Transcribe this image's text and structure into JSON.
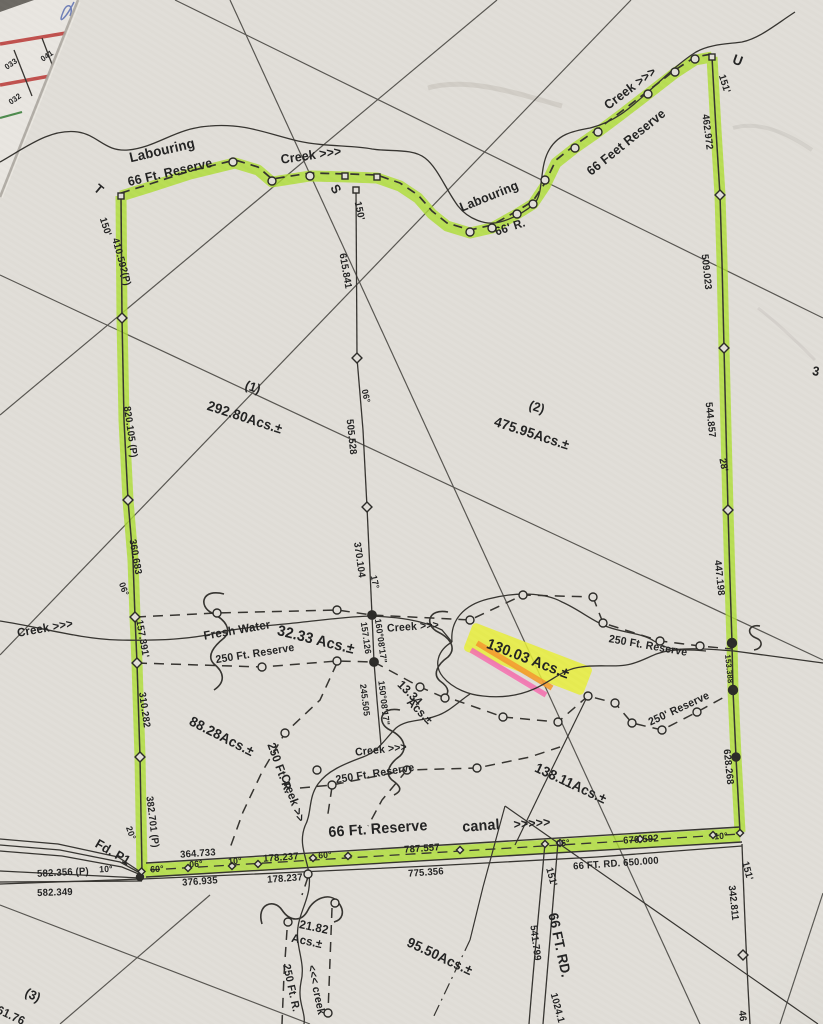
{
  "document_type_note": "hand-annotated survey plat photograph",
  "colors": {
    "highlight_green": "#aedd33",
    "highlight_yellow": "#e7ef3a",
    "highlight_orange": "#f49b2f",
    "highlight_pink": "#f472b0",
    "paper": "#e1ded8",
    "ink": "#222222",
    "fragment_red": "#c0504d"
  },
  "labels": [
    {
      "t": "033",
      "x": 11,
      "y": 64,
      "r": -35,
      "s": 8,
      "n": "underlying-sheet-lot-033"
    },
    {
      "t": "041",
      "x": 47,
      "y": 56,
      "r": -35,
      "s": 8,
      "n": "underlying-sheet-lot-041"
    },
    {
      "t": "032",
      "x": 15,
      "y": 99,
      "r": -35,
      "s": 8,
      "n": "underlying-sheet-lot-032"
    },
    {
      "t": "T",
      "x": 99,
      "y": 189,
      "r": 40,
      "s": 13,
      "n": "corner-T"
    },
    {
      "t": "Labouring",
      "x": 162,
      "y": 150,
      "r": -13,
      "s": 14,
      "n": "creek-name"
    },
    {
      "t": "66 Ft. Reserve",
      "x": 170,
      "y": 172,
      "r": -13,
      "s": 13,
      "n": "reserve-label"
    },
    {
      "t": "Creek >>>",
      "x": 311,
      "y": 155,
      "r": -8,
      "s": 13,
      "n": "creek-name"
    },
    {
      "t": "S",
      "x": 336,
      "y": 189,
      "r": 60,
      "s": 13,
      "n": "corner-S"
    },
    {
      "t": "150'",
      "x": 359,
      "y": 211,
      "r": 78,
      "s": 10
    },
    {
      "t": "150'",
      "x": 105,
      "y": 227,
      "r": 72,
      "s": 10
    },
    {
      "t": "Labouring",
      "x": 489,
      "y": 196,
      "r": -22,
      "s": 13,
      "n": "creek-name"
    },
    {
      "t": "66' R.",
      "x": 510,
      "y": 227,
      "r": -18,
      "s": 12
    },
    {
      "t": "Creek >>>",
      "x": 630,
      "y": 88,
      "r": -37,
      "s": 13,
      "n": "creek-name"
    },
    {
      "t": "66 Feet Reserve",
      "x": 626,
      "y": 142,
      "r": -39,
      "s": 13,
      "n": "reserve-label"
    },
    {
      "t": "U",
      "x": 738,
      "y": 60,
      "r": 20,
      "s": 14,
      "n": "corner-U"
    },
    {
      "t": "151'",
      "x": 724,
      "y": 84,
      "r": 72,
      "s": 10
    },
    {
      "t": "462.972",
      "x": 707,
      "y": 132,
      "r": 83,
      "s": 10
    },
    {
      "t": "509.023",
      "x": 706,
      "y": 272,
      "r": 84,
      "s": 10
    },
    {
      "t": "544.857",
      "x": 710,
      "y": 420,
      "r": 84,
      "s": 10
    },
    {
      "t": "28'",
      "x": 723,
      "y": 465,
      "r": 80,
      "s": 10
    },
    {
      "t": "3",
      "x": 816,
      "y": 371,
      "r": 10,
      "s": 13
    },
    {
      "t": "410.592(P)",
      "x": 121,
      "y": 262,
      "r": 75,
      "s": 10
    },
    {
      "t": "820.105 (P)",
      "x": 130,
      "y": 432,
      "r": 82,
      "s": 10
    },
    {
      "t": "360.683",
      "x": 135,
      "y": 557,
      "r": 80,
      "s": 10
    },
    {
      "t": "06°",
      "x": 124,
      "y": 589,
      "r": 70,
      "s": 9
    },
    {
      "t": "157.391'",
      "x": 142,
      "y": 639,
      "r": 80,
      "s": 10
    },
    {
      "t": "310.282",
      "x": 144,
      "y": 710,
      "r": 82,
      "s": 10
    },
    {
      "t": "382.701 (P)",
      "x": 152,
      "y": 822,
      "r": 83,
      "s": 10
    },
    {
      "t": "20°",
      "x": 131,
      "y": 833,
      "r": 70,
      "s": 9
    },
    {
      "t": "Fd. P1",
      "x": 113,
      "y": 852,
      "r": 30,
      "s": 13,
      "n": "found-pin-label"
    },
    {
      "t": "615.841",
      "x": 345,
      "y": 271,
      "r": 80,
      "s": 10
    },
    {
      "t": "(1)",
      "x": 253,
      "y": 387,
      "r": 18,
      "s": 13,
      "n": "parcel-1-number"
    },
    {
      "t": "292.80Acs.±",
      "x": 245,
      "y": 417,
      "r": 18,
      "s": 14,
      "n": "parcel-1-acreage"
    },
    {
      "t": "(2)",
      "x": 537,
      "y": 407,
      "r": 18,
      "s": 13,
      "n": "parcel-2-number"
    },
    {
      "t": "475.95Acs.±",
      "x": 532,
      "y": 433,
      "r": 18,
      "s": 14,
      "n": "parcel-2-acreage"
    },
    {
      "t": "06°",
      "x": 366,
      "y": 396,
      "r": 78,
      "s": 9
    },
    {
      "t": "505.528",
      "x": 351,
      "y": 437,
      "r": 84,
      "s": 10
    },
    {
      "t": "370.104",
      "x": 359,
      "y": 560,
      "r": 82,
      "s": 10
    },
    {
      "t": "17°",
      "x": 375,
      "y": 582,
      "r": 78,
      "s": 9
    },
    {
      "t": "Creek >>>",
      "x": 45,
      "y": 628,
      "r": -10,
      "s": 12,
      "n": "creek-name"
    },
    {
      "t": "Fresh Water",
      "x": 237,
      "y": 630,
      "r": -10,
      "s": 12,
      "n": "fresh-water-label"
    },
    {
      "t": "32.33 Acs.±",
      "x": 316,
      "y": 640,
      "r": 14,
      "s": 15,
      "n": "acreage-32-33"
    },
    {
      "t": "250 Ft. Reserve",
      "x": 255,
      "y": 654,
      "r": -9,
      "s": 11
    },
    {
      "t": "Creek >>>",
      "x": 413,
      "y": 627,
      "r": -4,
      "s": 11,
      "n": "creek-name"
    },
    {
      "t": "157.126",
      "x": 366,
      "y": 638,
      "r": 82,
      "s": 9
    },
    {
      "t": "160°08'17\"",
      "x": 381,
      "y": 641,
      "r": 82,
      "s": 9
    },
    {
      "t": "130.03 Acs.±",
      "x": 528,
      "y": 659,
      "r": 21,
      "s": 15,
      "n": "highlighted-acreage-130-03"
    },
    {
      "t": "250 Ft. Reserve",
      "x": 648,
      "y": 646,
      "r": 10,
      "s": 11
    },
    {
      "t": "250' Reserve",
      "x": 679,
      "y": 709,
      "r": -25,
      "s": 11
    },
    {
      "t": "447.198",
      "x": 719,
      "y": 578,
      "r": 84,
      "s": 10
    },
    {
      "t": "153.388",
      "x": 729,
      "y": 669,
      "r": 84,
      "s": 8
    },
    {
      "t": "628.268",
      "x": 728,
      "y": 767,
      "r": 84,
      "s": 10
    },
    {
      "t": "13.34",
      "x": 410,
      "y": 693,
      "r": 45,
      "s": 12,
      "n": "acreage-13-34"
    },
    {
      "t": "Acs.±",
      "x": 420,
      "y": 711,
      "r": 45,
      "s": 12
    },
    {
      "t": "245.505",
      "x": 365,
      "y": 700,
      "r": 83,
      "s": 9
    },
    {
      "t": "150°08'17\"",
      "x": 384,
      "y": 703,
      "r": 83,
      "s": 9
    },
    {
      "t": "88.28Acs.±",
      "x": 222,
      "y": 736,
      "r": 27,
      "s": 14,
      "n": "acreage-88-28"
    },
    {
      "t": "250 Ft. R.",
      "x": 280,
      "y": 768,
      "r": 70,
      "s": 12
    },
    {
      "t": "Creek >>",
      "x": 293,
      "y": 798,
      "r": 70,
      "s": 12,
      "n": "creek-name"
    },
    {
      "t": "Creek >>>",
      "x": 381,
      "y": 750,
      "r": -6,
      "s": 11,
      "n": "creek-name"
    },
    {
      "t": "250 Ft. Reserve",
      "x": 375,
      "y": 774,
      "r": -9,
      "s": 11
    },
    {
      "t": "138.11Acs.±",
      "x": 571,
      "y": 783,
      "r": 25,
      "s": 14,
      "n": "acreage-138-11"
    },
    {
      "t": "66 Ft. Reserve",
      "x": 378,
      "y": 829,
      "r": -4,
      "s": 15,
      "n": "canal-reserve-label"
    },
    {
      "t": "canal",
      "x": 481,
      "y": 826,
      "r": -4,
      "s": 15,
      "n": "canal-label"
    },
    {
      "t": ">>>>>",
      "x": 532,
      "y": 823,
      "r": -4,
      "s": 13
    },
    {
      "t": "364.733",
      "x": 198,
      "y": 854,
      "r": -4,
      "s": 10
    },
    {
      "t": "60°",
      "x": 157,
      "y": 869,
      "r": -4,
      "s": 9
    },
    {
      "t": "06°",
      "x": 196,
      "y": 864,
      "r": -4,
      "s": 9
    },
    {
      "t": "10°",
      "x": 235,
      "y": 861,
      "r": -4,
      "s": 9
    },
    {
      "t": "178.237",
      "x": 281,
      "y": 858,
      "r": -4,
      "s": 10
    },
    {
      "t": "60°",
      "x": 325,
      "y": 855,
      "r": -4,
      "s": 9
    },
    {
      "t": "787.557",
      "x": 422,
      "y": 849,
      "r": -4,
      "s": 10
    },
    {
      "t": "06°",
      "x": 563,
      "y": 843,
      "r": -4,
      "s": 9
    },
    {
      "t": "670.592",
      "x": 641,
      "y": 840,
      "r": -4,
      "s": 10
    },
    {
      "t": "10°",
      "x": 721,
      "y": 836,
      "r": -4,
      "s": 9
    },
    {
      "t": "376.935",
      "x": 200,
      "y": 882,
      "r": -4,
      "s": 10
    },
    {
      "t": "178.237",
      "x": 285,
      "y": 879,
      "r": -4,
      "s": 10
    },
    {
      "t": "775.356",
      "x": 426,
      "y": 873,
      "r": -4,
      "s": 10
    },
    {
      "t": "66 FT. RD.  650.000",
      "x": 616,
      "y": 864,
      "r": -4,
      "s": 10,
      "n": "road-label"
    },
    {
      "t": "582.356 (P)",
      "x": 63,
      "y": 873,
      "r": -3,
      "s": 10
    },
    {
      "t": "10°",
      "x": 106,
      "y": 869,
      "r": -3,
      "s": 9
    },
    {
      "t": "582.349",
      "x": 55,
      "y": 893,
      "r": -2,
      "s": 10
    },
    {
      "t": "(3)",
      "x": 33,
      "y": 995,
      "r": 25,
      "s": 13,
      "n": "parcel-3-number"
    },
    {
      "t": "161.76",
      "x": 8,
      "y": 1014,
      "r": 25,
      "s": 12
    },
    {
      "t": "21.82",
      "x": 314,
      "y": 927,
      "r": 12,
      "s": 12,
      "n": "acreage-21-82"
    },
    {
      "t": "Acs.±",
      "x": 307,
      "y": 941,
      "r": 12,
      "s": 12
    },
    {
      "t": "250 Ft. R.",
      "x": 291,
      "y": 988,
      "r": 78,
      "s": 11
    },
    {
      "t": "<<< creek",
      "x": 316,
      "y": 990,
      "r": 78,
      "s": 11,
      "n": "creek-name"
    },
    {
      "t": "95.50Acs.±",
      "x": 440,
      "y": 956,
      "r": 25,
      "s": 14,
      "n": "acreage-95-50"
    },
    {
      "t": "151'",
      "x": 551,
      "y": 877,
      "r": 75,
      "s": 10
    },
    {
      "t": "66 FT. RD.",
      "x": 560,
      "y": 945,
      "r": 78,
      "s": 14,
      "n": "road-label"
    },
    {
      "t": "541.799",
      "x": 535,
      "y": 943,
      "r": 83,
      "s": 10
    },
    {
      "t": "1024.1",
      "x": 557,
      "y": 1008,
      "r": 75,
      "s": 10
    },
    {
      "t": "151'",
      "x": 747,
      "y": 871,
      "r": 75,
      "s": 10
    },
    {
      "t": "342.811",
      "x": 733,
      "y": 903,
      "r": 84,
      "s": 10
    },
    {
      "t": "46",
      "x": 742,
      "y": 1016,
      "r": 84,
      "s": 10
    }
  ]
}
